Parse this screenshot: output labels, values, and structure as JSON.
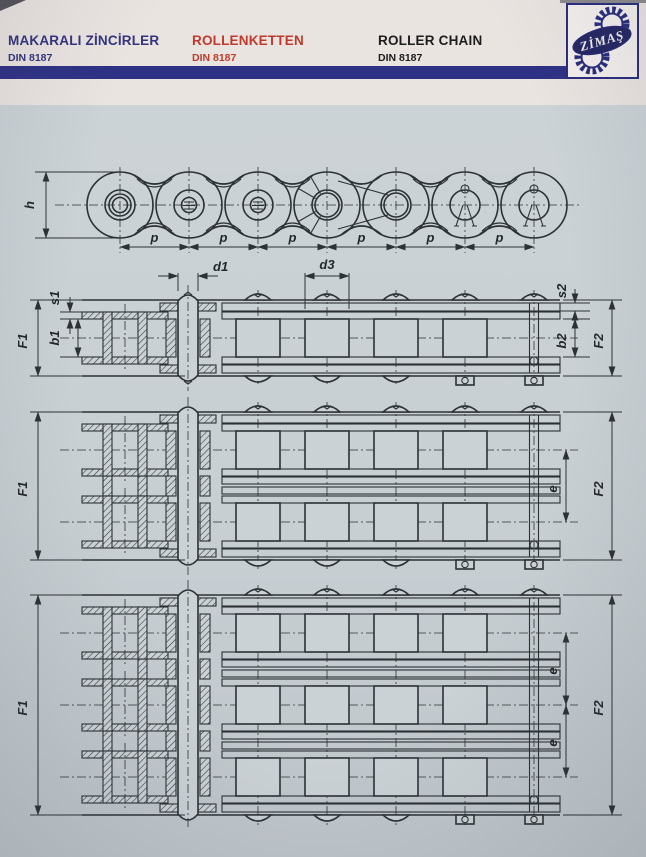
{
  "header": {
    "columns": [
      {
        "title": "MAKARALI ZİNCİRLER",
        "subtitle": "DIN 8187"
      },
      {
        "title": "ROLLENKETTEN",
        "subtitle": "DIN 8187"
      },
      {
        "title": "ROLLER CHAIN",
        "subtitle": "DIN 8187"
      }
    ],
    "logo": {
      "text": "ZİMAŞ"
    },
    "colors": {
      "navy": "#2f3185",
      "red": "#bf3a2c",
      "black": "#1d1d1f"
    }
  },
  "drawing": {
    "labels": {
      "h": "h",
      "p": "p",
      "d1": "d1",
      "d3": "d3",
      "s1": "s1",
      "b1": "b1",
      "s2": "s2",
      "b2": "b2",
      "F1": "F1",
      "F2": "F2",
      "e": "e"
    },
    "views": {
      "top": "roller chain side elevation",
      "row1": "simplex chain plan section",
      "row2": "duplex chain plan section",
      "row3": "triplex chain plan section"
    }
  }
}
